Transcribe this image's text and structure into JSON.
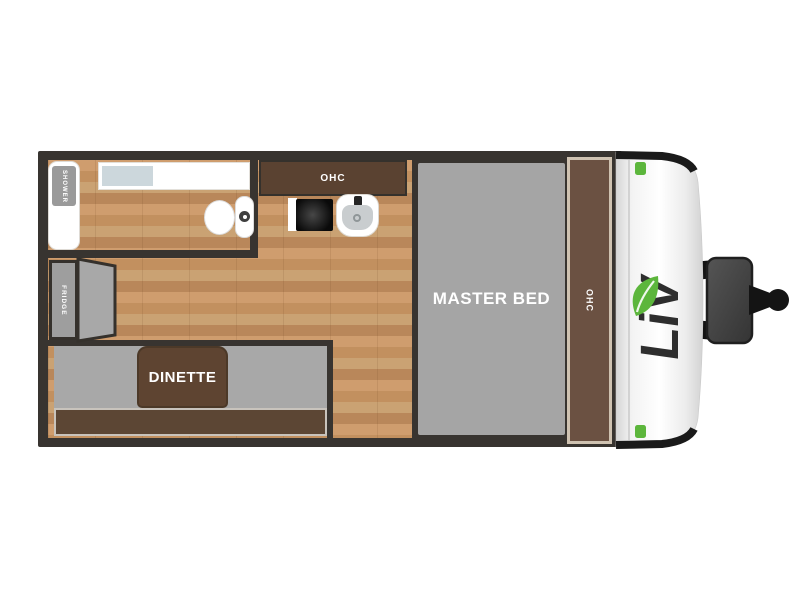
{
  "floorplan": {
    "labels": {
      "shower": "SHOWER",
      "fridge": "FRIDGE",
      "dinette": "DINETTE",
      "kitchen_ohc": "OHC",
      "front_ohc": "OHC",
      "master_bed": "MASTER BED"
    },
    "brand": {
      "logo_text": "LiV"
    },
    "colors": {
      "wall": "#383430",
      "wood_light": "#cf9d6e",
      "wood_dark": "#b9875a",
      "cabinet_brown": "#5a4231",
      "front_cabinet_brown": "#6b5142",
      "cabinet_trim": "#cfc2b1",
      "bed_gray": "#a5a5a5",
      "bench_gray": "#a8a8a8",
      "fridge_gray": "#9e9e9e",
      "counter_inset_blue": "#ccd7dc",
      "accent_green": "#5cb63c",
      "hitch_gray": "#474747",
      "black_trim": "#1a1a1a"
    }
  }
}
